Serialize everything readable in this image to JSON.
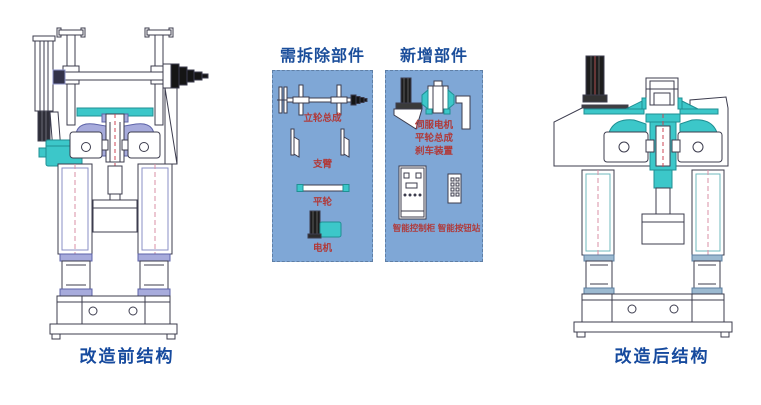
{
  "before": {
    "caption": "改造前结构"
  },
  "after": {
    "caption": "改造后结构"
  },
  "panels": {
    "remove": {
      "title": "需拆除部件",
      "items": [
        {
          "label": "立轮总成"
        },
        {
          "label": "支臂"
        },
        {
          "label": "平轮"
        },
        {
          "label": "电机"
        }
      ]
    },
    "add": {
      "title": "新增部件",
      "items": [
        {
          "label": "伺服电机"
        },
        {
          "label": "平轮总成"
        },
        {
          "label": "刹车装置"
        },
        {
          "label": "智能控制柜"
        },
        {
          "label": "智能按钮站"
        }
      ]
    }
  },
  "colors": {
    "panel_background": "#7fa7d6",
    "title_blue": "#1b4e9b",
    "caption_blue": "#164a9e",
    "label_red": "#b03a3a",
    "teal_accent": "#3cc7c9",
    "lavender_accent": "#a7abdc",
    "line_dark": "#3c3c4e"
  }
}
